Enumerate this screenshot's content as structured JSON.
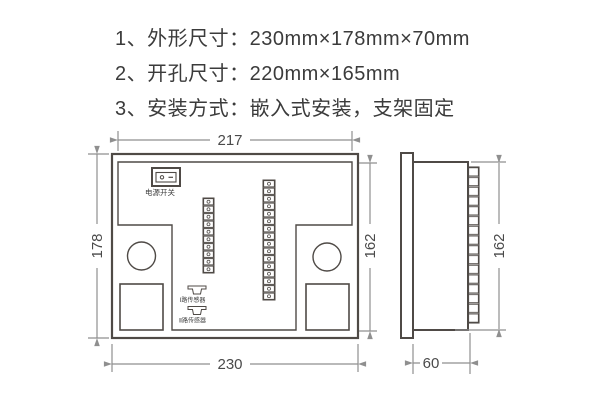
{
  "specs": {
    "items": [
      {
        "text": "1、外形尺寸：230mm×178mm×70mm"
      },
      {
        "text": "2、开孔尺寸：220mm×165mm"
      },
      {
        "text": "3、安装方式：嵌入式安装，支架固定"
      }
    ]
  },
  "drawing": {
    "rear_view": {
      "power_switch_label": "电源开关",
      "sensor1_label": "Ⅰ路传感器",
      "sensor2_label": "Ⅱ路传感器",
      "dim_inner_width": "217",
      "dim_outer_width": "230",
      "dim_outer_height": "178",
      "dim_inner_height": "162"
    },
    "side_view": {
      "dim_height": "162",
      "dim_depth": "60"
    },
    "colors": {
      "shape_line": "#4f4a46",
      "dimension_line": "#8f8f8f",
      "text": "#3b3b3b"
    }
  }
}
